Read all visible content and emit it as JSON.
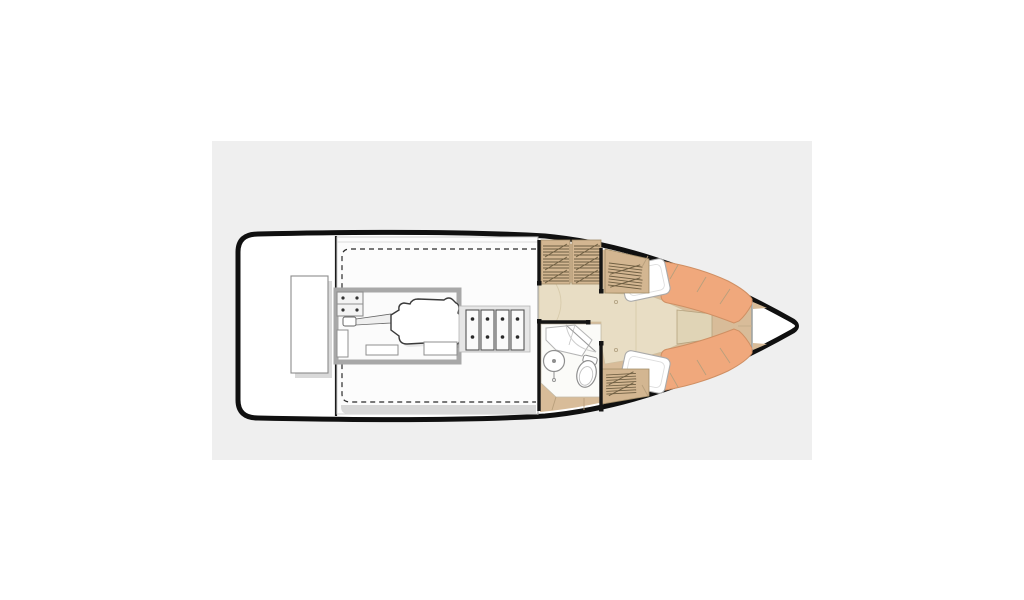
{
  "scene": {
    "kind": "boat-deck-plan",
    "orientation": "bow-right",
    "parts": [
      "transom",
      "aft-deck",
      "transom-bench",
      "cockpit",
      "cockpit-hatch-outline",
      "engine-room",
      "engine-block",
      "propeller-shaft",
      "shaft-coupling",
      "mount-plate",
      "battery-bank",
      "cabin",
      "companionway-steps",
      "vent-lockers",
      "head-compartment",
      "sink",
      "toilet",
      "shower-bench",
      "head-door",
      "v-berth",
      "berth-cushion-port",
      "berth-cushion-starboard",
      "pillow-port",
      "pillow-starboard",
      "berth-infill",
      "side-decks",
      "bow-locker"
    ]
  },
  "colors": {
    "page_bg": "#ffffff",
    "panel_bg": "#efefef",
    "hull_fill": "#ffffff",
    "hull_outline": "#101010",
    "deck_wood": "#d8bc99",
    "locker_wood": "#d3b691",
    "hatch_line": "#6e5e42",
    "cabin_floor": "#e8ddc4",
    "berth_infill": "#e0d4b6",
    "cushion_orange": "#f0a87c",
    "cushion_outline": "#cf8f63",
    "pillow_white": "#ffffff",
    "head_floor": "#fbfbf8",
    "gray_band": "#d8d8d8",
    "frame_gray": "#a8a8a8",
    "wall_black": "#141414",
    "seam_line": "#b89f7c"
  }
}
